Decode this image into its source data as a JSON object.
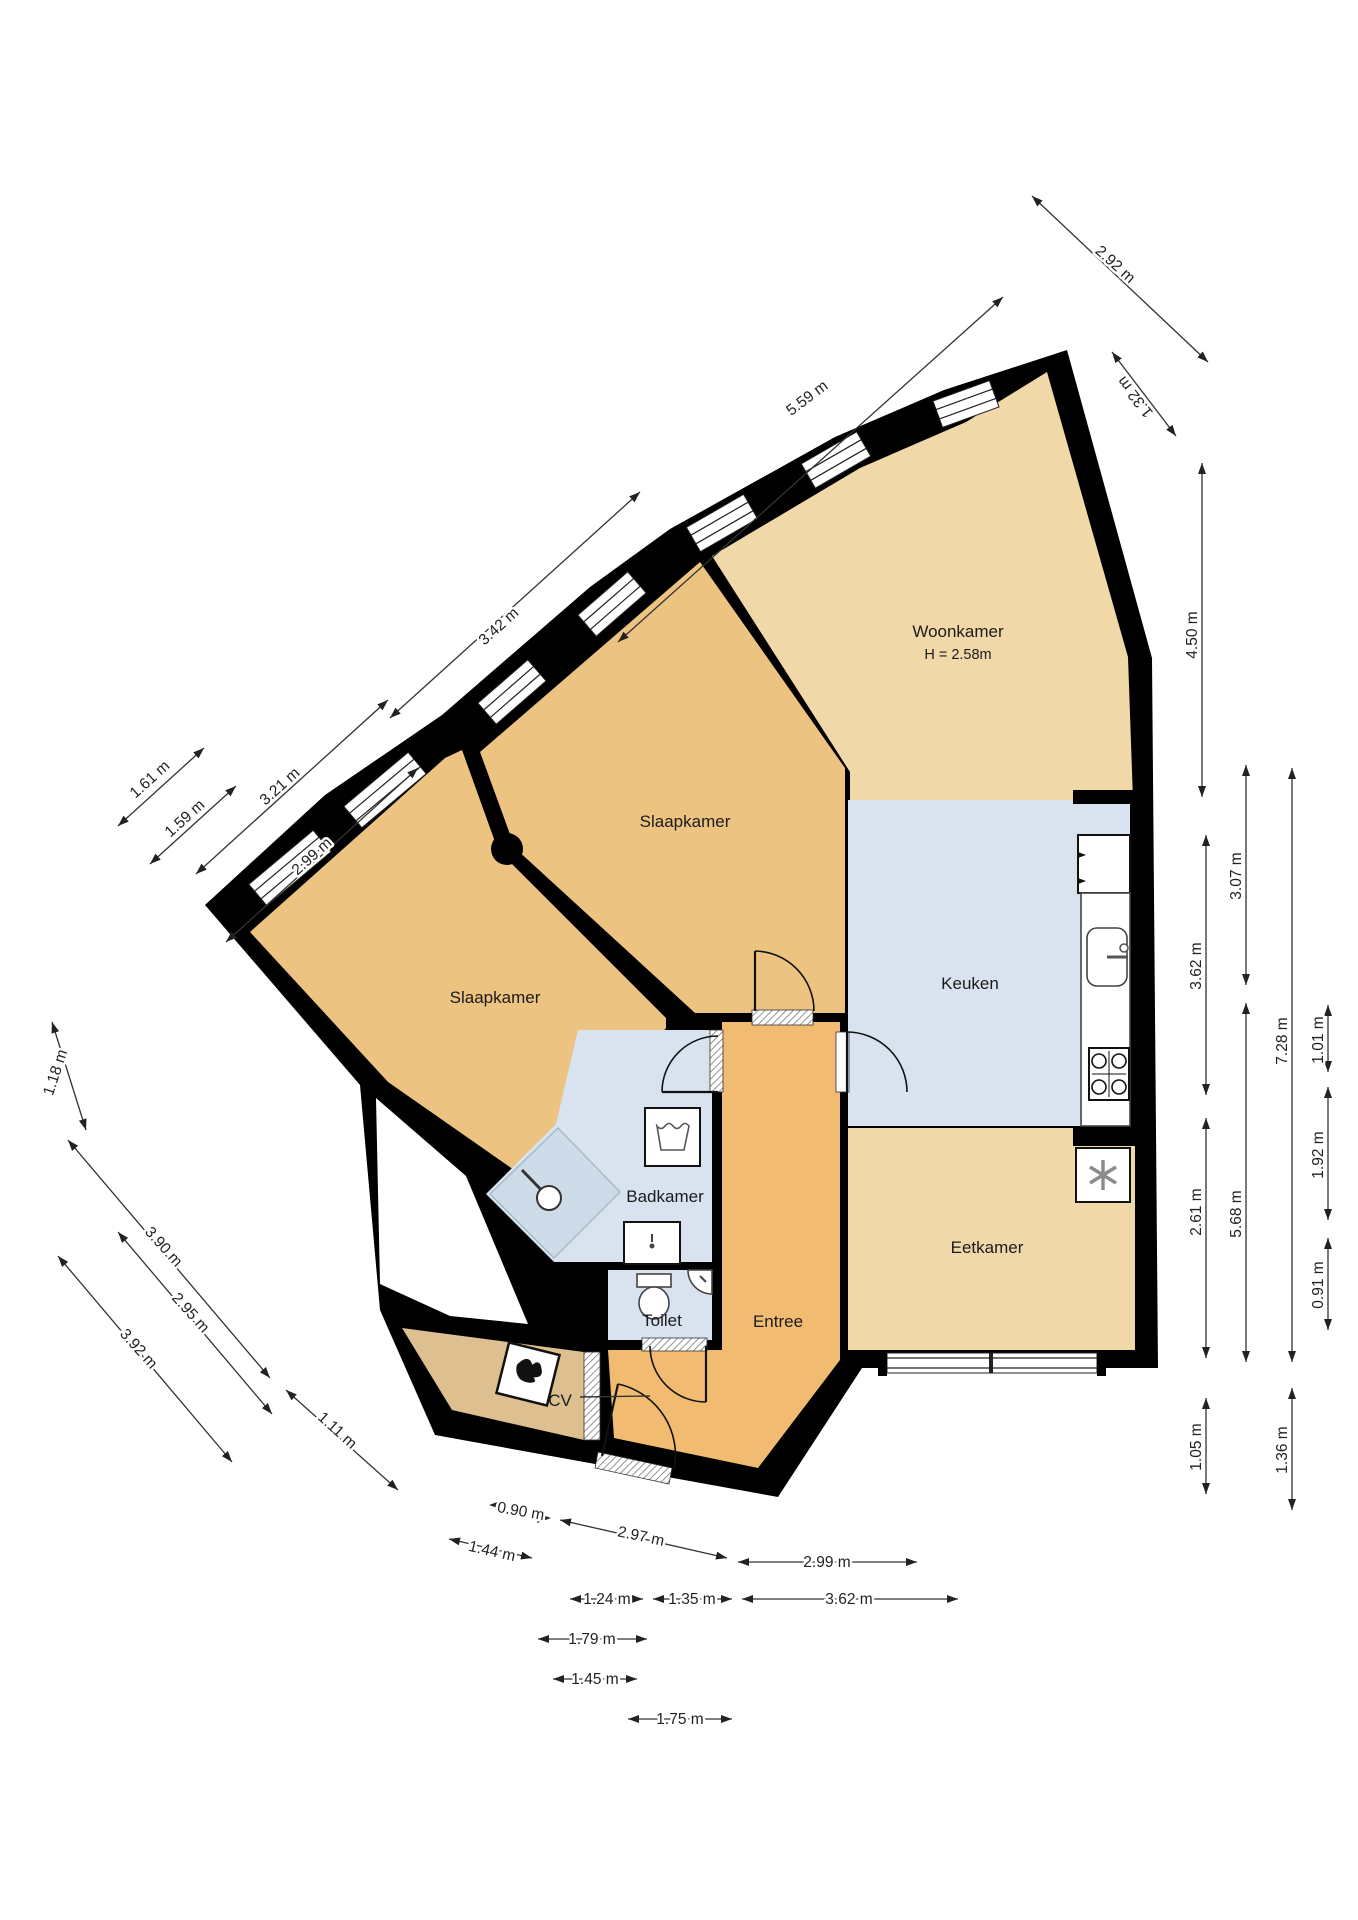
{
  "rooms": {
    "woonkamer": {
      "label": "Woonkamer",
      "height_note": "H = 2.58m"
    },
    "slaapkamer_top": {
      "label": "Slaapkamer"
    },
    "slaapkamer_left": {
      "label": "Slaapkamer"
    },
    "keuken": {
      "label": "Keuken"
    },
    "eetkamer": {
      "label": "Eetkamer"
    },
    "badkamer": {
      "label": "Badkamer"
    },
    "toilet": {
      "label": "Toilet"
    },
    "entree": {
      "label": "Entree"
    },
    "cv": {
      "label": "CV"
    }
  },
  "dimensions": {
    "top": [
      "2.92 m",
      "1.32 m",
      "5.59 m",
      "3.42 m",
      "3.21 m",
      "2.99 m",
      "1.61 m",
      "1.59 m"
    ],
    "left": [
      "1.18 m",
      "3.90 m",
      "2.95 m",
      "3.92 m",
      "1.11 m"
    ],
    "right": [
      "4.50 m",
      "3.07 m",
      "3.62 m",
      "7.28 m",
      "1.01 m",
      "1.92 m",
      "2.61 m",
      "5.68 m",
      "0.91 m",
      "1.05 m",
      "1.36 m"
    ],
    "bottom": [
      "0.90 m",
      "2.97 m",
      "1.44 m",
      "2.99 m",
      "1.24 m",
      "1.35 m",
      "3.62 m",
      "1.79 m",
      "1.45 m",
      "1.75 m"
    ]
  },
  "colors": {
    "wall": "#000000",
    "floor_tan": "#f0d8a9",
    "floor_orange": "#ecc381",
    "floor_entree": "#f2bb72",
    "floor_cv": "#ddbf90",
    "floor_blue": "#d8e3ef",
    "shower_blue": "#cedbe9",
    "dim_text": "#222222"
  },
  "fixtures": [
    "shower-head-icon",
    "washing-machine-icon",
    "washbasin-icon",
    "toilet-bowl-icon",
    "corner-sink-icon",
    "kitchen-sink-icon",
    "stove-icon",
    "fridge-snowflake-icon",
    "cv-boiler-icon",
    "column-icon"
  ]
}
